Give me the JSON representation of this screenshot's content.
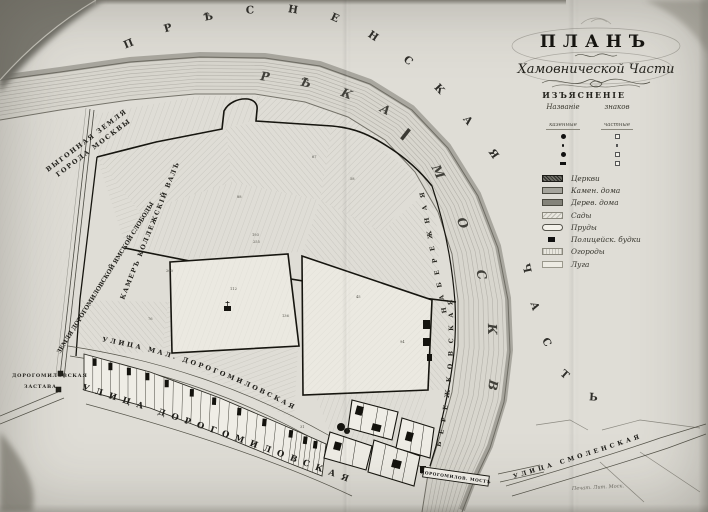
{
  "colors": {
    "paper": "#dfddd6",
    "river": "#d8d6ce",
    "ink": "#1a1914"
  },
  "title": {
    "main": "ПЛАНЪ",
    "sub": "Хамовнической Части"
  },
  "legend": {
    "header": "ИЗЪЯСНЕНІЕ",
    "columns": {
      "left_header": "Названіе",
      "right_header": "знаков",
      "left_sub": "казенные",
      "right_sub": "частные"
    },
    "items": [
      {
        "label": "Церкви"
      },
      {
        "label": "Камен. дома"
      },
      {
        "label": "Дерев. дома"
      },
      {
        "label": "Сады"
      },
      {
        "label": "Пруды"
      },
      {
        "label": "Полицейск. будки"
      },
      {
        "label": "Огороды"
      },
      {
        "label": "Луга"
      }
    ]
  },
  "labels": {
    "district_word1": "ПРѢСНЕНСКАЯ",
    "district_word2": "ЧАСТЬ",
    "river_word1": "РѢКА",
    "river_word2": "МОСКВА",
    "embankment_word1": "БЕРЕЖКОВСКАЯ",
    "embankment_word2": "НАБЕРЕЖНАЯ",
    "street_malaya": "УЛИЦА МАЛ. ДОРОГОМИЛОВСКАЯ",
    "street_bolshaya": "УЛИЦА ДОРОГОМИЛОВСКАЯ",
    "street_smolenskaya": "УЛИЦА СМОЛЕНСКАЯ",
    "bridge": "ДОРОГОМИЛОВ. МОСТЪ",
    "vygon_line1": "ВЫГОННАЯ ЗЕМЛЯ",
    "vygon_line2": "ГОРОДА МОСКВЫ",
    "yamskaya": "ЗЕМЛЯ ДОРОГОМИЛОВСКОЙ ЯМСКОЙ СЛОБОДЫ",
    "val": "КАМЕРЪ КОЛЛЕЖСКІЙ ВАЛЪ",
    "zastava_line1": "ДОРОГОМИЛОВСКАЯ",
    "zastava_line2": "ЗАСТАВА",
    "imprint": "Печат. Лит. Моск."
  },
  "parcel_numbers": [
    {
      "t": "193",
      "x": 252,
      "y": 236
    },
    {
      "t": "255",
      "x": 253,
      "y": 243
    },
    {
      "t": "88",
      "x": 237,
      "y": 198
    },
    {
      "t": "136",
      "x": 282,
      "y": 317
    },
    {
      "t": "94",
      "x": 400,
      "y": 343
    },
    {
      "t": "67",
      "x": 312,
      "y": 158
    },
    {
      "t": "200",
      "x": 166,
      "y": 272
    },
    {
      "t": "45",
      "x": 356,
      "y": 298
    },
    {
      "t": "76",
      "x": 148,
      "y": 320
    },
    {
      "t": "31",
      "x": 300,
      "y": 428
    },
    {
      "t": "58",
      "x": 350,
      "y": 180
    },
    {
      "t": "112",
      "x": 230,
      "y": 290
    }
  ]
}
